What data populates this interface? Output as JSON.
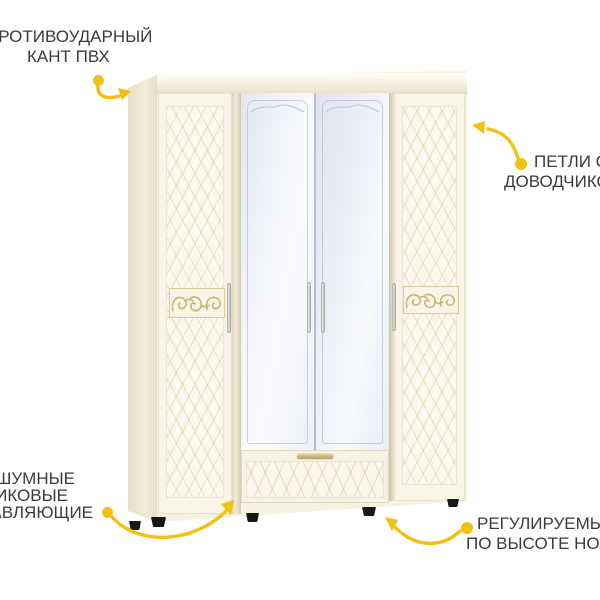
{
  "canvas": {
    "background": "#ffffff",
    "accent_color": "#f2c00e",
    "label_text_color": "#3a3a3a"
  },
  "product": {
    "name": "four-door wardrobe with mirrored center doors and bottom drawer",
    "body_color": "#f6f2e1",
    "side_color": "#e9e2cb",
    "mirror_color": "#eef1f7",
    "ornament_color": "#c9b478",
    "feet_color": "#171717"
  },
  "annotations": {
    "impact_edge": {
      "line1": "ПРОТИВОУДАРНЫЙ",
      "line2": "КАНТ ПВХ"
    },
    "hinges": {
      "line1": "ПЕТЛИ С",
      "line2": "ДОВОДЧИКОМ"
    },
    "guides": {
      "line1": "БЕСШУМНЫЕ",
      "line2": "ШАРИКОВЫЕ",
      "line3": "НАПРАВЛЯЮЩИЕ"
    },
    "legs": {
      "line1": "РЕГУЛИРУЕМЫЕ",
      "line2": "ПО ВЫСОТЕ НОЖКИ"
    }
  }
}
